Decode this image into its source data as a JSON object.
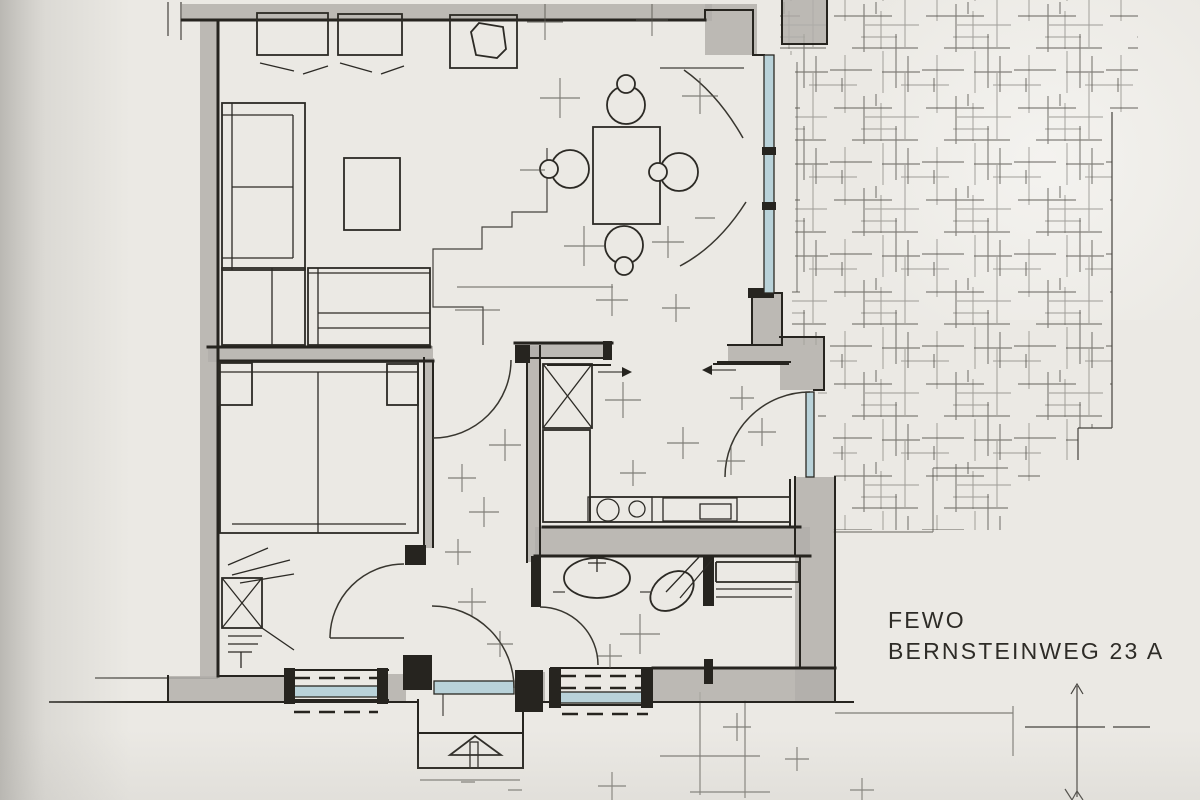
{
  "title": {
    "line1": "FEWO",
    "line2": "BERNSTEINWEG 23 A"
  },
  "colors": {
    "paper": "#ebe9e4",
    "ink": "#26241f",
    "wall_shading": "#b1afa9",
    "pencil": "#56544e",
    "glazing": "#b9d2d9"
  }
}
